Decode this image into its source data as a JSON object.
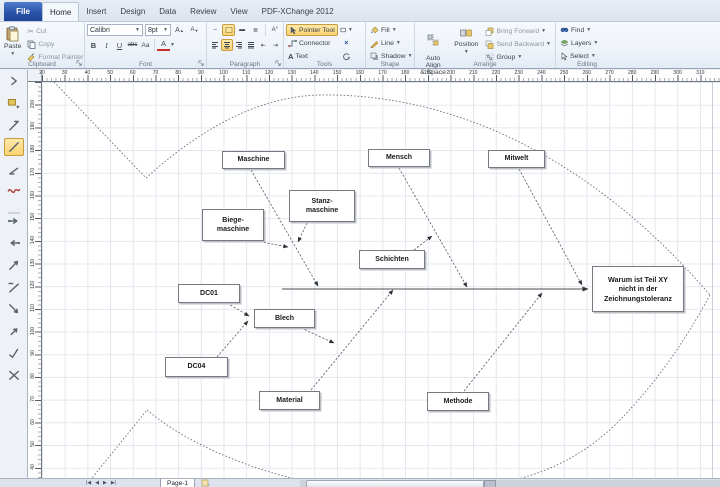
{
  "tabs": {
    "file": "File",
    "active": "Home",
    "items": [
      "Home",
      "Insert",
      "Design",
      "Data",
      "Review",
      "View",
      "PDF-XChange 2012"
    ]
  },
  "ribbon": {
    "clipboard": {
      "group": "Clipboard",
      "paste": "Paste",
      "cut": "Cut",
      "copy": "Copy",
      "format_painter": "Format Painter"
    },
    "font": {
      "group": "Font",
      "family": "Calibri",
      "size": "8pt",
      "bold": "B",
      "italic": "I",
      "underline": "U",
      "strike": "abc",
      "case": "Aa",
      "color": "A"
    },
    "paragraph": {
      "group": "Paragraph"
    },
    "tools": {
      "group": "Tools",
      "pointer": "Pointer Tool",
      "connector": "Connector",
      "text": "Text"
    },
    "shape": {
      "group": "Shape",
      "fill": "Fill",
      "line": "Line",
      "shadow": "Shadow"
    },
    "arrange": {
      "group": "Arrange",
      "auto_align": "Auto Align\n& Space",
      "position": "Position",
      "bring_forward": "Bring Forward",
      "send_backward": "Send Backward",
      "group_btn": "Group"
    },
    "editing": {
      "group": "Editing",
      "find": "Find",
      "layers": "Layers",
      "select": "Select"
    }
  },
  "rulers": {
    "horizontal": [
      20,
      30,
      40,
      50,
      60,
      70,
      80,
      90,
      100,
      110,
      120,
      130,
      140,
      150,
      160,
      170,
      180,
      190,
      200,
      210,
      220,
      230,
      240,
      250,
      260,
      270,
      280,
      290,
      300,
      310
    ],
    "vertical": [
      200,
      190,
      180,
      170,
      160,
      150,
      140,
      130,
      120,
      110,
      100,
      90,
      80,
      70,
      60,
      50,
      40
    ]
  },
  "stencil": {
    "icons": [
      {
        "name": "stencil-collapse-chevron-icon",
        "g": "chevron"
      },
      {
        "name": "stencil-shapes-window-icon",
        "g": "shapes"
      },
      {
        "name": "stencil-category-shape-icon",
        "g": "catline"
      },
      {
        "name": "stencil-selected-shape-icon",
        "g": "diag",
        "selected": true
      },
      {
        "name": "stencil-line-shape-icon",
        "g": "diag2"
      },
      {
        "name": "stencil-fishbone-shape-icon",
        "g": "fish",
        "red": true
      },
      {
        "name": "stencil-divider",
        "g": "sep"
      },
      {
        "name": "stencil-arrow-right-icon",
        "g": "arrowr"
      },
      {
        "name": "stencil-arrow-left-icon",
        "g": "arrowl"
      },
      {
        "name": "stencil-diagonal-arrow-up-icon",
        "g": "diagup"
      },
      {
        "name": "stencil-diagonal-line-icon",
        "g": "diagtext"
      },
      {
        "name": "stencil-diagonal-arrow-down-icon",
        "g": "diagdown"
      },
      {
        "name": "stencil-small-arrow-icon",
        "g": "smallarrow"
      },
      {
        "name": "stencil-check-arrow-icon",
        "g": "check"
      },
      {
        "name": "stencil-crossed-arrows-icon",
        "g": "cross"
      }
    ]
  },
  "diagram": {
    "boxes": [
      {
        "id": "maschine",
        "label": "Maschine",
        "x": 222,
        "y": 151,
        "w": 63,
        "h": 18
      },
      {
        "id": "mensch",
        "label": "Mensch",
        "x": 368,
        "y": 149,
        "w": 62,
        "h": 18
      },
      {
        "id": "mitwelt",
        "label": "Mitwelt",
        "x": 488,
        "y": 150,
        "w": 57,
        "h": 18
      },
      {
        "id": "stanz",
        "label": "Stanz-\nmaschine",
        "x": 289,
        "y": 190,
        "w": 66,
        "h": 32
      },
      {
        "id": "biege",
        "label": "Biege-\nmaschine",
        "x": 202,
        "y": 209,
        "w": 62,
        "h": 32
      },
      {
        "id": "schichten",
        "label": "Schichten",
        "x": 359,
        "y": 250,
        "w": 66,
        "h": 19
      },
      {
        "id": "dc01",
        "label": "DC01",
        "x": 178,
        "y": 284,
        "w": 62,
        "h": 19
      },
      {
        "id": "blech",
        "label": "Blech",
        "x": 254,
        "y": 309,
        "w": 61,
        "h": 19
      },
      {
        "id": "dc04",
        "label": "DC04",
        "x": 165,
        "y": 357,
        "w": 63,
        "h": 20
      },
      {
        "id": "material",
        "label": "Material",
        "x": 259,
        "y": 391,
        "w": 61,
        "h": 19
      },
      {
        "id": "methode",
        "label": "Methode",
        "x": 427,
        "y": 392,
        "w": 62,
        "h": 19
      },
      {
        "id": "effect",
        "label": "Warum ist Teil XY\nnicht in der\nZeichnungstoleranz",
        "x": 592,
        "y": 266,
        "w": 92,
        "h": 46
      }
    ],
    "connectors": [
      {
        "id": "spine",
        "x1": 282,
        "y1": 289,
        "x2": 588,
        "y2": 289,
        "dashed": false
      },
      {
        "id": "bone-maschine",
        "x1": 251,
        "y1": 170,
        "x2": 318,
        "y2": 286,
        "dashed": true
      },
      {
        "id": "bone-mensch",
        "x1": 399,
        "y1": 168,
        "x2": 467,
        "y2": 287,
        "dashed": true
      },
      {
        "id": "bone-mitwelt",
        "x1": 519,
        "y1": 169,
        "x2": 582,
        "y2": 285,
        "dashed": true
      },
      {
        "id": "bone-material",
        "x1": 311,
        "y1": 390,
        "x2": 393,
        "y2": 290,
        "dashed": true
      },
      {
        "id": "bone-methode",
        "x1": 464,
        "y1": 391,
        "x2": 542,
        "y2": 293,
        "dashed": true
      },
      {
        "id": "sub-stanz",
        "x1": 307,
        "y1": 223,
        "x2": 298,
        "y2": 242,
        "dashed": true
      },
      {
        "id": "sub-biege",
        "x1": 256,
        "y1": 241,
        "x2": 288,
        "y2": 247,
        "dashed": true
      },
      {
        "id": "sub-schichten",
        "x1": 414,
        "y1": 250,
        "x2": 432,
        "y2": 236,
        "dashed": true
      },
      {
        "id": "sub-blech",
        "x1": 301,
        "y1": 328,
        "x2": 334,
        "y2": 343,
        "dashed": true
      },
      {
        "id": "sub-dc01",
        "x1": 227,
        "y1": 303,
        "x2": 249,
        "y2": 316,
        "dashed": true
      },
      {
        "id": "sub-dc04",
        "x1": 217,
        "y1": 357,
        "x2": 248,
        "y2": 321,
        "dashed": true
      }
    ],
    "fish_outline": [
      "M54,82 L146,178",
      "M146,178 C210,120 268,96 320,95 C450,93 590,155 710,295",
      "M710,295 C680,350 650,390 615,425 C570,468 520,482 470,488 C400,495 330,490 273,473 C230,460 183,440 147,410",
      "M88,483 L147,410"
    ]
  },
  "page_bar": {
    "page_tab": "Page-1"
  },
  "colors": {
    "highlight_yellow": "#fbd470",
    "file_tab_blue": "#2a55a8",
    "grid": "#e3e7ed",
    "fishbone_red": "#b03a2e",
    "font_color_red": "#c33026"
  }
}
